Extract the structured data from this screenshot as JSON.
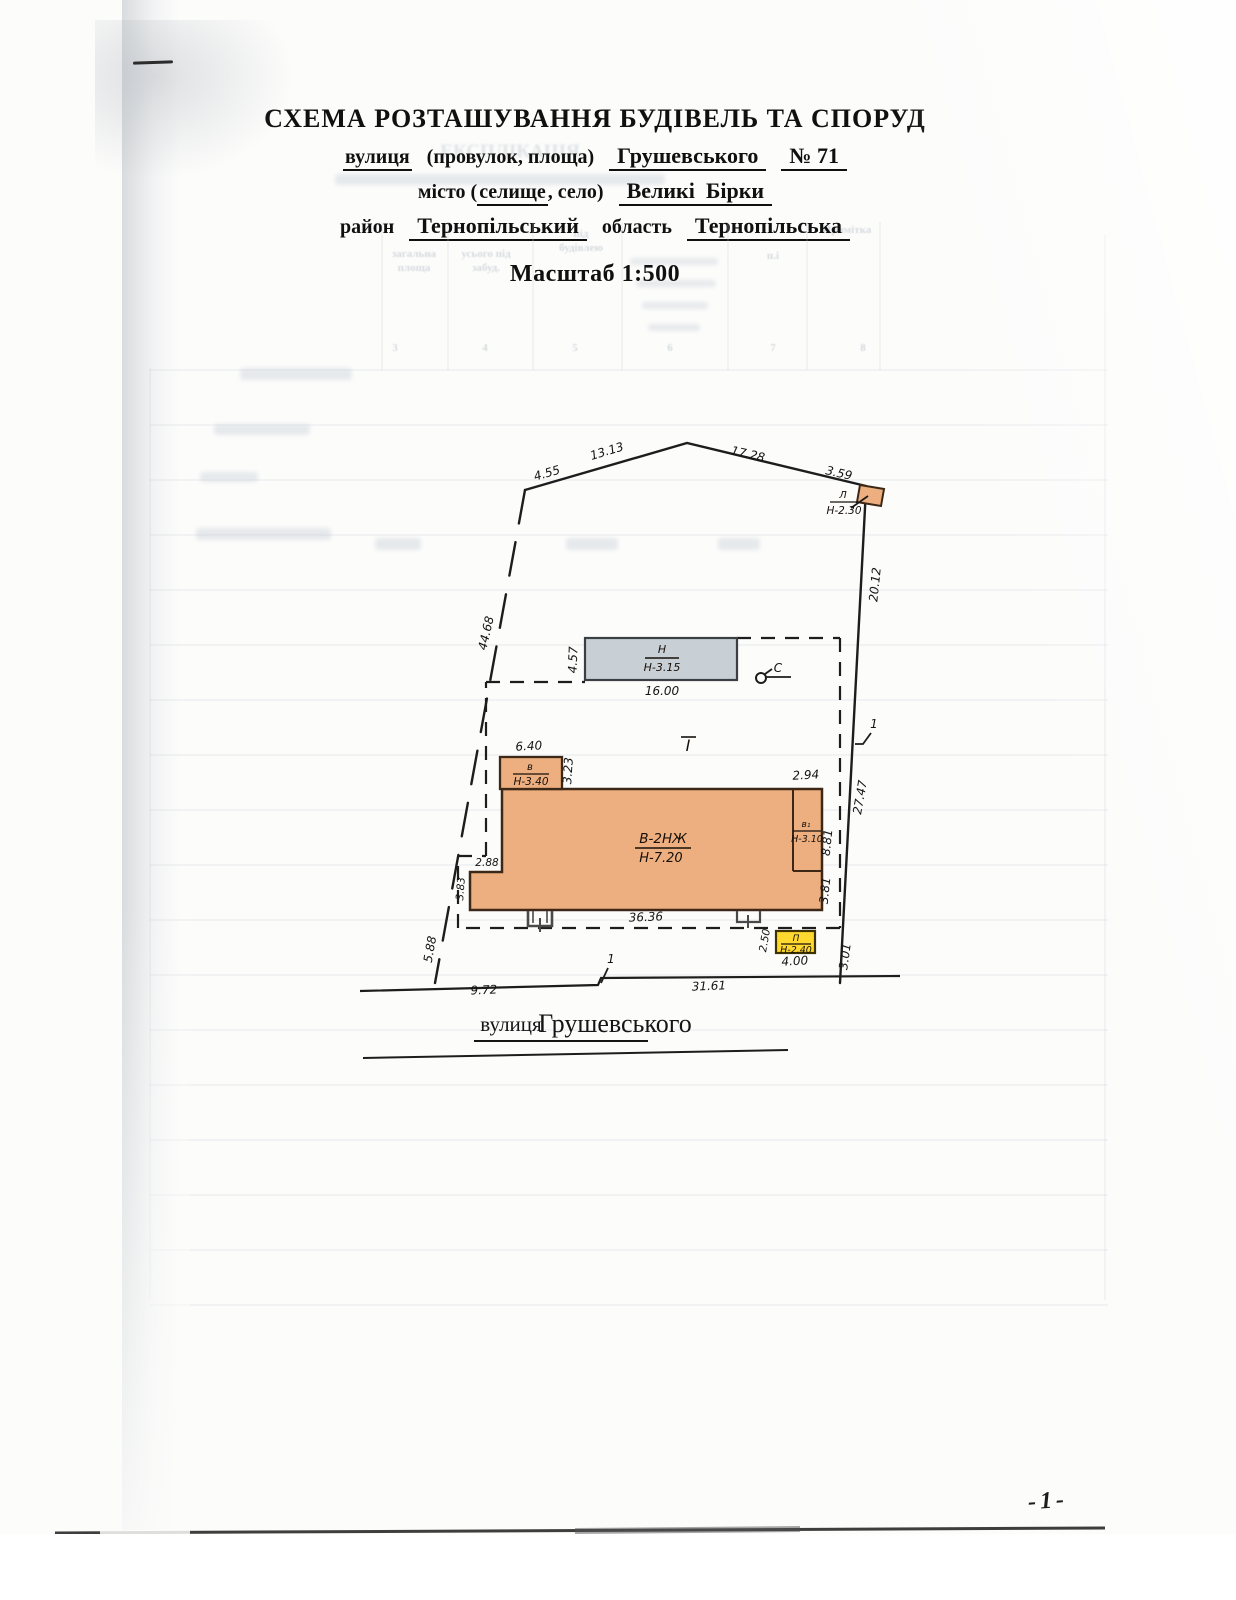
{
  "page": {
    "page_number": "-1-"
  },
  "header": {
    "title": "СХЕМА РОЗТАШУВАННЯ БУДІВЕЛЬ ТА СПОРУД",
    "address_label": "вулиця",
    "address_label_paren": "(провулок, площа)",
    "address_value": "Грушевського",
    "address_number": "№ 71",
    "city_pre": "місто (",
    "city_mid": "селище",
    "city_post": ", село)",
    "city_value": "Великі  Бірки",
    "district_label": "район",
    "district_value": "Тернопільський",
    "region_label": "область",
    "region_value": "Тернопільська",
    "scale": "Масштаб 1:500"
  },
  "ghost": {
    "title": "ЕКСПЛІКАЦІЯ",
    "col1": "загальна площа",
    "col2": "усього під забуд.",
    "col3": "під будівлею",
    "col4": "п.і",
    "col5": "Примітка",
    "nums": [
      "3",
      "4",
      "5",
      "6",
      "7",
      "8"
    ]
  },
  "plan": {
    "street": {
      "prefix": "вулиця",
      "name": "Грушевського"
    },
    "plot_number": "І",
    "point_right": "1",
    "point_street": "1",
    "buildings": {
      "main": {
        "code": "В-2НЖ",
        "height": "Н-7.20"
      },
      "gray": {
        "code": "Н",
        "height": "Н-3.15"
      },
      "annex": {
        "code": "в",
        "height": "Н-3.40"
      },
      "v1": {
        "code": "в₁",
        "height": "Н-3.10"
      },
      "l": {
        "code": "Л",
        "height": "Н-2.30"
      },
      "p": {
        "code": "П",
        "height": "Н-2.40"
      },
      "well": {
        "code": "С"
      }
    },
    "dims": {
      "top1": "4.55",
      "top2": "13.13",
      "top3": "17.28",
      "top4": "3.59",
      "left": "44.68",
      "right_upper": "20.12",
      "right_mid": "27.47",
      "right_lower": "3.01",
      "left_lower": "5.88",
      "step_w": "2.88",
      "step_h": "3.83",
      "gray_left": "4.57",
      "gray_bottom": "16.00",
      "annex_top": "6.40",
      "annex_right": "3.23",
      "v1_top": "2.94",
      "v1_right": "8.81",
      "v1_lower": "3.81",
      "main_bottom": "36.36",
      "p_left": "2.50",
      "p_bottom": "4.00",
      "street_left": "9.72",
      "street_right": "31.61"
    }
  },
  "colors": {
    "building_orange": "#edaf7f",
    "building_gray": "#c8d0d5",
    "building_yellow": "#ffd930",
    "line": "#1d1d1d"
  }
}
